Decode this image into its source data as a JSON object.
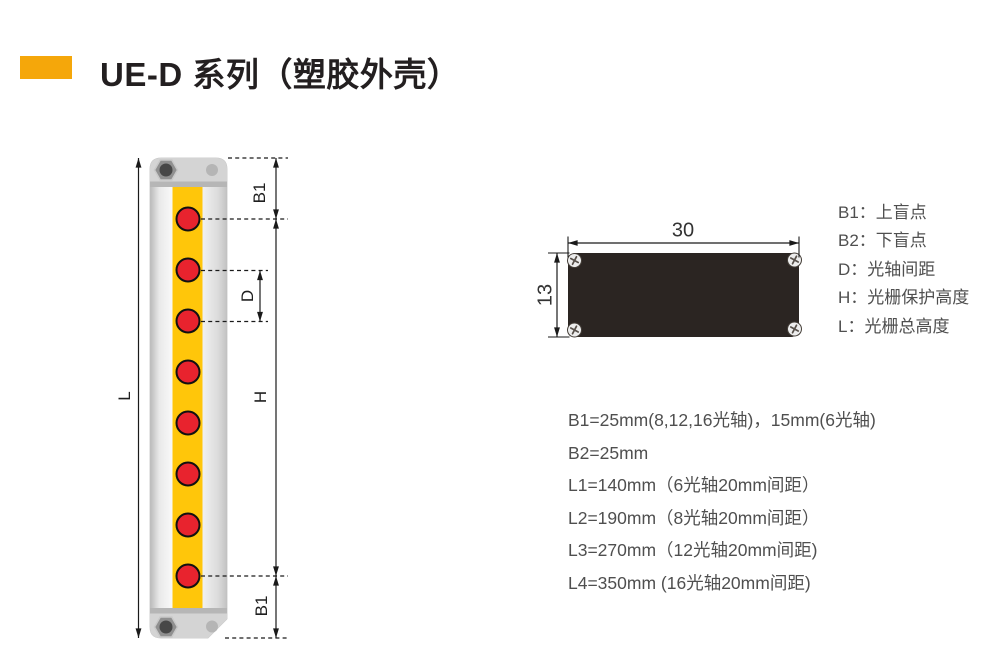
{
  "header": {
    "title": "UE-D 系列（塑胶外壳）"
  },
  "light_curtain": {
    "beam_count": 8,
    "dims": {
      "blind_top": "B1",
      "pitch": "D",
      "protect_height": "H",
      "total_height": "L",
      "blind_bottom": "B1"
    }
  },
  "cross_section": {
    "width": "30",
    "height": "13"
  },
  "legend": {
    "items": [
      "B1：上盲点",
      "B2：下盲点",
      "D：光轴间距",
      "H：光栅保护高度",
      "L：光栅总高度"
    ]
  },
  "specs": {
    "items": [
      "B1=25mm(8,12,16光轴)，15mm(6光轴)",
      "B2=25mm",
      "L1=140mm（6光轴20mm间距）",
      "L2=190mm（8光轴20mm间距）",
      "L3=270mm（12光轴20mm间距)",
      "L4=350mm (16光轴20mm间距)"
    ]
  },
  "colors": {
    "accent_orange": "#F5A70A",
    "strip_yellow": "#FFC60A",
    "beam_red": "#E8232E",
    "housing_dark": "#2B2522",
    "text_dark": "#231F20",
    "text_gray": "#4F4F4F",
    "line_black": "#1A1A1A"
  }
}
